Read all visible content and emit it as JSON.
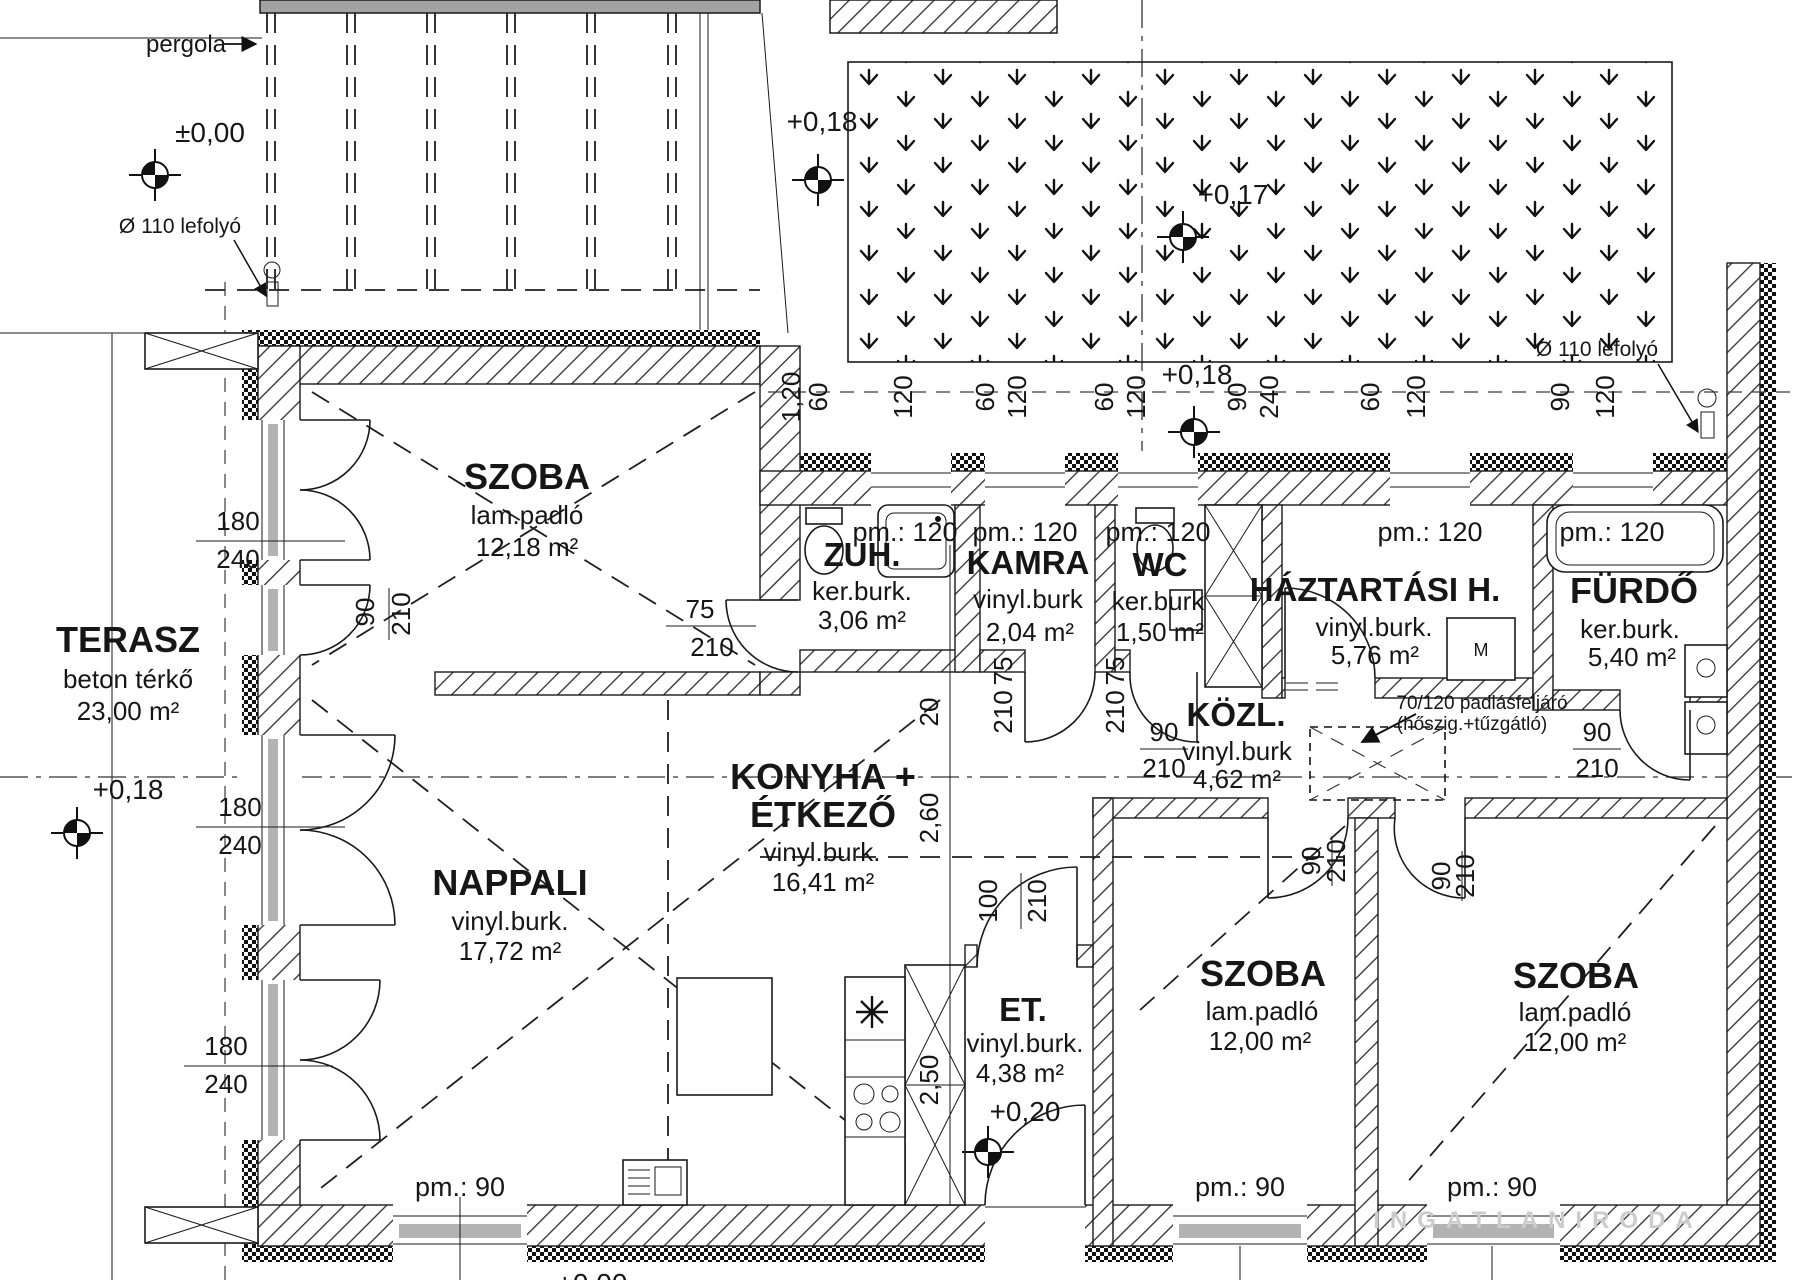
{
  "rooms": {
    "terasz": {
      "name": "TERASZ",
      "finish": "beton térkő",
      "area": "23,00 m²"
    },
    "szoba_felso": {
      "name": "SZOBA",
      "finish": "lam.padló",
      "area": "12,18 m²"
    },
    "nappali": {
      "name": "NAPPALI",
      "finish": "vinyl.burk.",
      "area": "17,72 m²",
      "sill": "pm.: 90"
    },
    "konyha_etkezo": {
      "name_line1": "KONYHA +",
      "name_line2": "ÉTKEZŐ",
      "finish": "vinyl.burk.",
      "area": "16,41 m²"
    },
    "zuhanyzo": {
      "name": "ZUH.",
      "finish": "ker.burk.",
      "area": "3,06 m²",
      "sill": "pm.: 120"
    },
    "kamra": {
      "name": "KAMRA",
      "finish": "vinyl.burk",
      "area": "2,04 m²",
      "sill": "pm.: 120"
    },
    "wc": {
      "name": "WC",
      "finish": "ker.burk",
      "area": "1,50 m²",
      "sill": "pm.: 120"
    },
    "haztartasi": {
      "name": "HÁZTARTÁSI H.",
      "finish": "vinyl.burk.",
      "area": "5,76 m²",
      "sill": "pm.: 120"
    },
    "furdo": {
      "name": "FÜRDŐ",
      "finish": "ker.burk.",
      "area": "5,40 m²",
      "sill": "pm.: 120"
    },
    "kozlekedo": {
      "name": "KÖZL.",
      "finish": "vinyl.burk",
      "area": "4,62 m²"
    },
    "eloter": {
      "name": "ET.",
      "finish": "vinyl.burk.",
      "area": "4,38 m²",
      "level": "+0,20"
    },
    "szoba_kozepso": {
      "name": "SZOBA",
      "finish": "lam.padló",
      "area": "12,00 m²",
      "sill": "pm.: 90"
    },
    "szoba_jobb": {
      "name": "SZOBA",
      "finish": "lam.padló",
      "area": "12,00 m²",
      "sill": "pm.: 90"
    }
  },
  "annotations": {
    "pergola": "pergola",
    "level_zero": "±0,00",
    "level_018": "+0,18",
    "level_017": "+0,17",
    "level_cut": "+0,00",
    "drain": "Ø 110 lefolyó",
    "attic_line1": "70/120 padlásfeljáró",
    "attic_line2": "(hőszig.+tűzgátló)",
    "washer": "M"
  },
  "dims": {
    "top_chain": [
      "1,20",
      "60",
      "120",
      "60",
      "120",
      "60",
      "120",
      "90",
      "240",
      "60",
      "120",
      "90",
      "120"
    ],
    "opening_w": "180",
    "opening_h": "240",
    "door75": "75",
    "door90": "90",
    "door100": "100",
    "door_h": "210",
    "k20": "20",
    "k260": "2,60",
    "k250": "2,50"
  },
  "watermark": "INGATLANIRODA"
}
